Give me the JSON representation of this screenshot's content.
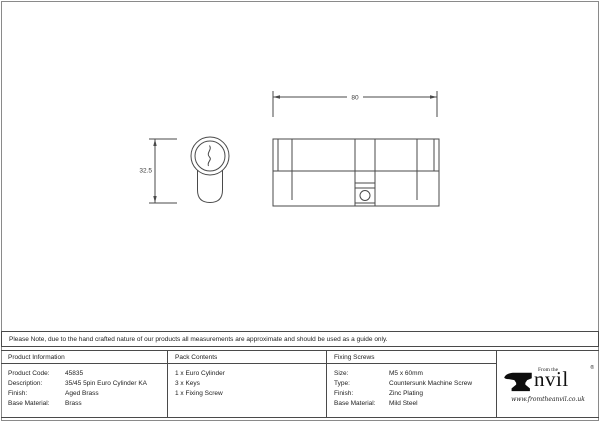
{
  "note": "Please Note, due to the hand crafted nature of our products all measurements are approximate and should be used as a guide only.",
  "drawing": {
    "width_dim": "80",
    "height_dim": "32.5"
  },
  "tables": {
    "product_information": {
      "header": "Product Information",
      "rows": [
        [
          "Product Code:",
          "45835"
        ],
        [
          "Description:",
          "35/45 5pin Euro Cylinder KA"
        ],
        [
          "Finish:",
          "Aged Brass"
        ],
        [
          "Base Material:",
          "Brass"
        ]
      ]
    },
    "pack_contents": {
      "header": "Pack Contents",
      "items": [
        "1 x Euro Cylinder",
        "3 x Keys",
        "1 x Fixing Screw"
      ]
    },
    "fixing_screws": {
      "header": "Fixing Screws",
      "rows": [
        [
          "Size:",
          "M5 x 60mm"
        ],
        [
          "Type:",
          "Countersunk Machine Screw"
        ],
        [
          "Finish:",
          "Zinc Plating"
        ],
        [
          "Base Material:",
          "Mild Steel"
        ]
      ]
    }
  },
  "logo": {
    "from_the": "From the",
    "name": "nvil",
    "registered": "®",
    "url": "www.fromtheanvil.co.uk"
  },
  "colors": {
    "line": "#4a4a4a",
    "border": "#4a4a4a",
    "text": "#1c1c1c",
    "background": "#ffffff"
  }
}
